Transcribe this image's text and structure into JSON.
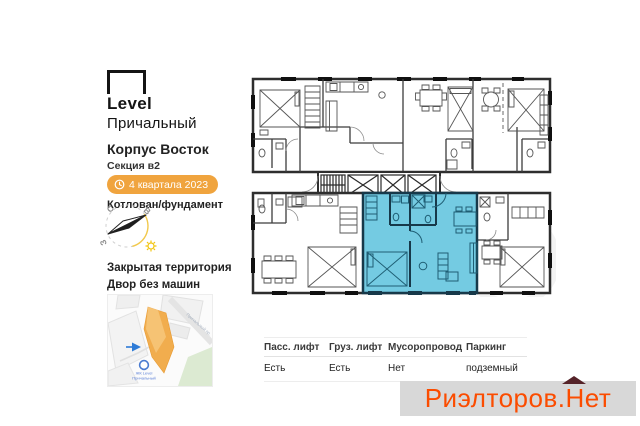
{
  "sidebar": {
    "logo": {
      "brand": "Level",
      "project": "Причальный"
    },
    "building": "Корпус Восток",
    "section": "Секция в2",
    "completion_badge": "4 квартала 2023",
    "construction_stage": "Котлован/фундамент",
    "compass": {
      "north": "С",
      "east": "В",
      "west": "З"
    },
    "features": [
      "Закрытая территория",
      "Двор без машин"
    ],
    "map": {
      "poi_line1": "ЖК Level",
      "poi_line2": "Причальный",
      "street": "Причальный пр."
    }
  },
  "floorplan": {
    "highlight_color": "#74cbe2",
    "highlight_wall_color": "#17394a",
    "wall_color": "#2e2e2e"
  },
  "specs": {
    "columns": [
      {
        "label": "Пасс. лифт",
        "value": "Есть"
      },
      {
        "label": "Груз. лифт",
        "value": "Есть"
      },
      {
        "label": "Мусоропровод",
        "value": "Нет"
      },
      {
        "label": "Паркинг",
        "value": "подземный"
      }
    ]
  },
  "watermark": {
    "prefix": "Риэлторов.",
    "suffix": "Нет",
    "text_color": "#fb4c00",
    "background": "#d8d8d8",
    "roof_color": "#552329"
  },
  "badge_color": "#f0a43e"
}
